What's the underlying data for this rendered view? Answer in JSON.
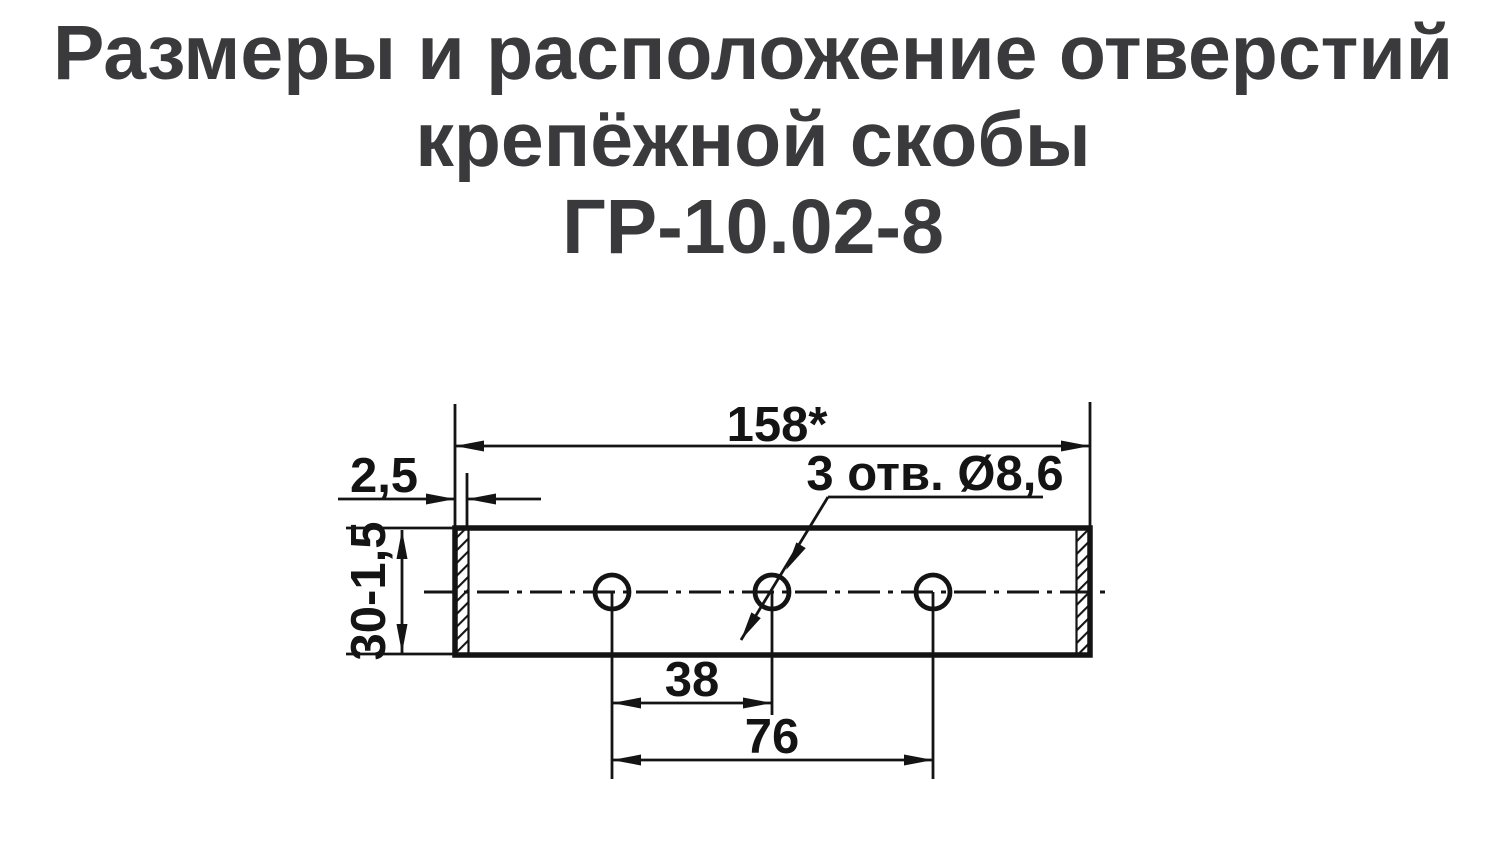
{
  "title": {
    "line1": "Размеры и расположение отверстий",
    "line2": "крепёжной скобы",
    "line3": "ГР-10.02-8"
  },
  "drawing": {
    "overall_length": "158*",
    "flange_thickness": "2,5",
    "plate_height": "30-1,5",
    "holes_note": "3 отв. Ø8,6",
    "hole_spacing": "38",
    "hole_span": "76",
    "holes_count": 3
  },
  "colors": {
    "line": "#141414",
    "title_text": "#3a3a3c",
    "background": "#ffffff"
  }
}
